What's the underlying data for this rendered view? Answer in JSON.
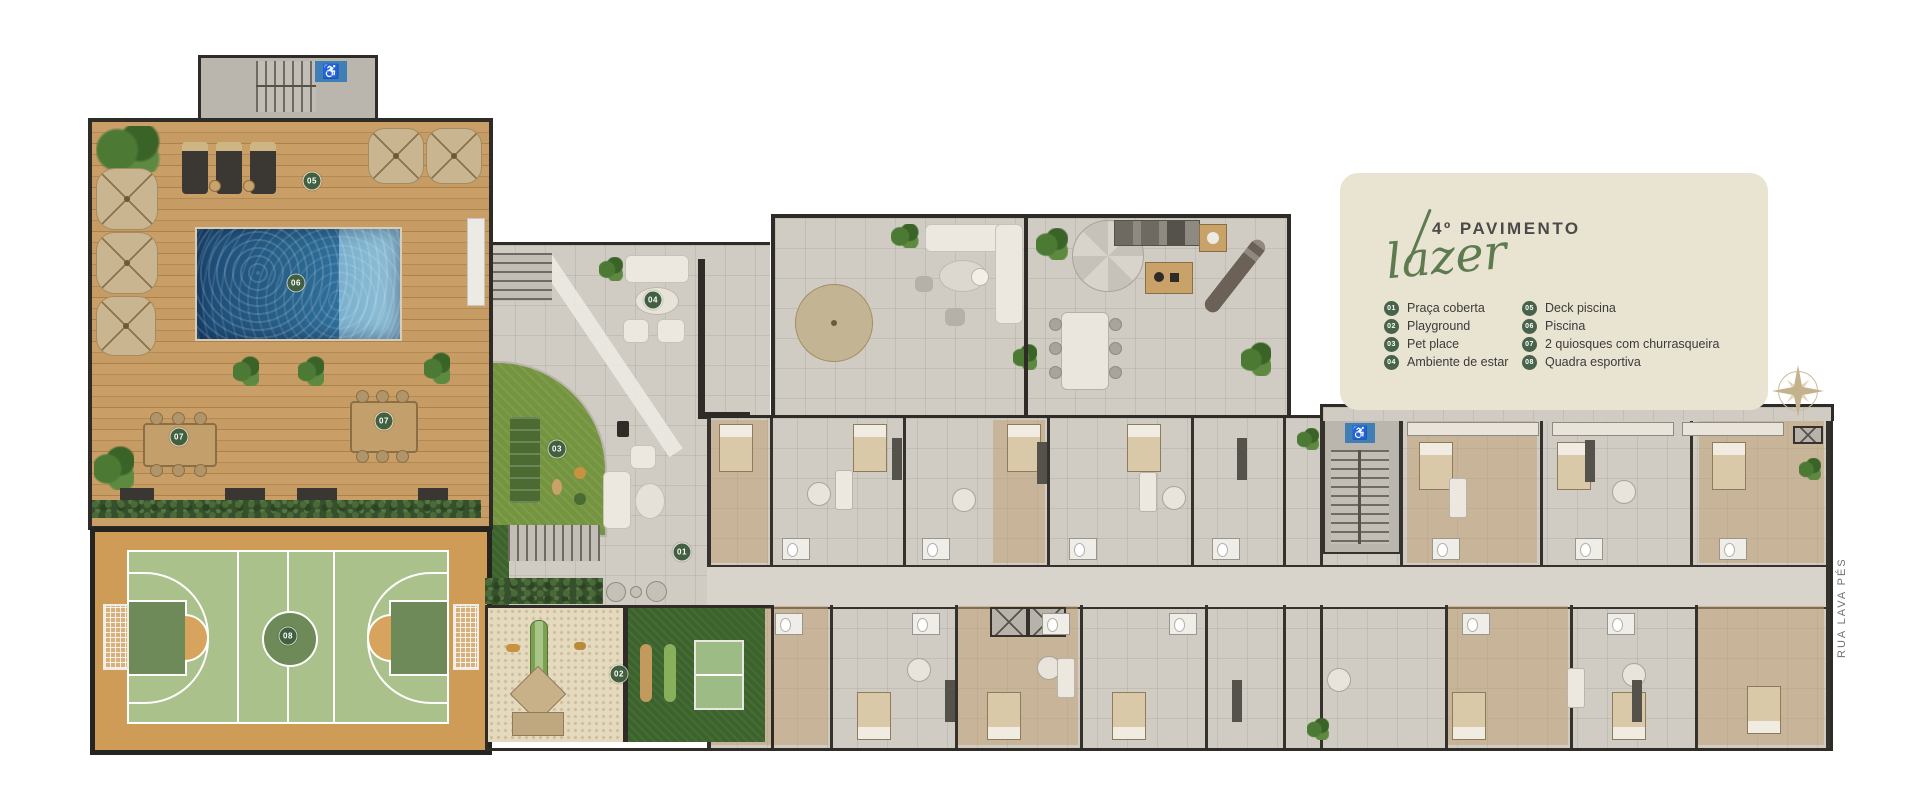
{
  "legend": {
    "floor_title": "4º PAVIMENTO",
    "category": "lazer",
    "items": [
      {
        "num": "01",
        "label": "Praça coberta"
      },
      {
        "num": "02",
        "label": "Playground"
      },
      {
        "num": "03",
        "label": "Pet place"
      },
      {
        "num": "04",
        "label": "Ambiente de estar"
      },
      {
        "num": "05",
        "label": "Deck piscina"
      },
      {
        "num": "06",
        "label": "Piscina"
      },
      {
        "num": "07",
        "label": "2 quiosques com churrasqueira"
      },
      {
        "num": "08",
        "label": "Quadra esportiva"
      }
    ]
  },
  "street_label": "RUA LAVA PÉS",
  "icons": {
    "accessible": "♿",
    "compass": "compass-rose"
  },
  "colors": {
    "legend_bg": "#e9e3d2",
    "accent_green": "#5d7b4f",
    "badge_green": "#42603f",
    "pool_blue": "#2a668f",
    "court_green": "#aac18c",
    "court_dark_green": "#6d8a58",
    "court_sand": "#cf9c58",
    "deck_wood": "#c49a62",
    "lawn_green": "#3c632c",
    "pet_lawn": "#74943f",
    "sand": "#e6dabe",
    "tile_gray": "#d0ccc4",
    "wall_dark": "#2f2b27",
    "handicap_blue": "#3f7fb5"
  }
}
